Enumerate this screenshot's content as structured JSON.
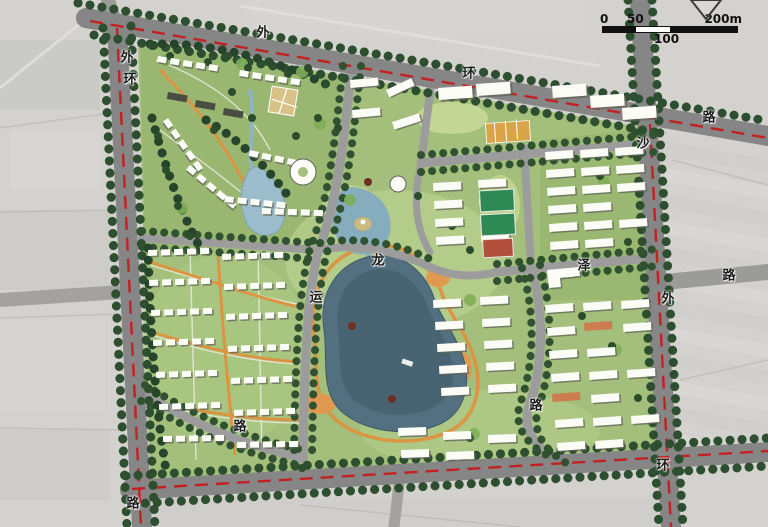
{
  "scale_bar": {
    "t0": "0",
    "t50": "50",
    "t100": "100",
    "t200": "200m"
  },
  "road_labels": [
    {
      "text": "外"
    },
    {
      "text": "环"
    },
    {
      "text": "路"
    },
    {
      "text": "外"
    },
    {
      "text": "环"
    },
    {
      "text": "路"
    },
    {
      "text": "沙"
    },
    {
      "text": "外"
    },
    {
      "text": "环"
    },
    {
      "text": "路"
    },
    {
      "text": "龙"
    },
    {
      "text": "运"
    },
    {
      "text": "泽"
    },
    {
      "text": "路"
    },
    {
      "text": "路"
    }
  ],
  "colors": {
    "boundary_road": "#868686",
    "red_centerline": "#c32121",
    "tree_green": "#2d4f2f",
    "site_green": "#a3bf7b",
    "lake_blue": "#52707f",
    "path_orange": "#de923f"
  }
}
